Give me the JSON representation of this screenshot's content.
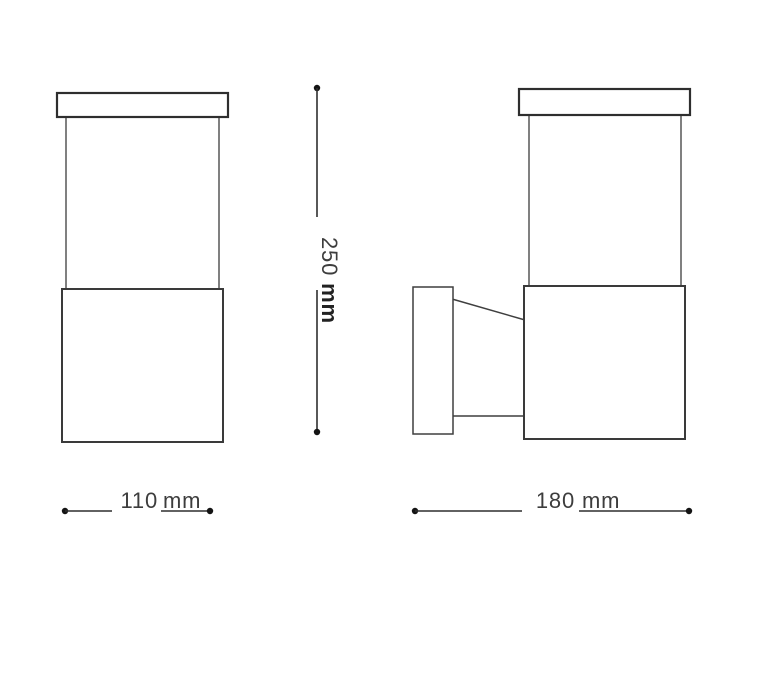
{
  "drawing": {
    "type": "technical-dimension-drawing",
    "views": {
      "front": {
        "parts": [
          "cap",
          "diffuser",
          "body"
        ]
      },
      "side": {
        "parts": [
          "cap",
          "diffuser",
          "body",
          "wall-plate",
          "bracket-arm"
        ]
      }
    },
    "dimensions": {
      "height": {
        "value": "250",
        "unit": "mm",
        "orientation": "vertical"
      },
      "width": {
        "value": "110",
        "unit": "mm",
        "orientation": "horizontal"
      },
      "depth": {
        "value": "180",
        "unit": "mm",
        "orientation": "horizontal"
      }
    },
    "colors": {
      "background": "#ffffff",
      "line": "#3a3a3a",
      "dim_line": "#2f2f2f",
      "text": "#3d3d3d",
      "unit_text": "#222222",
      "dot": "#141414"
    }
  }
}
